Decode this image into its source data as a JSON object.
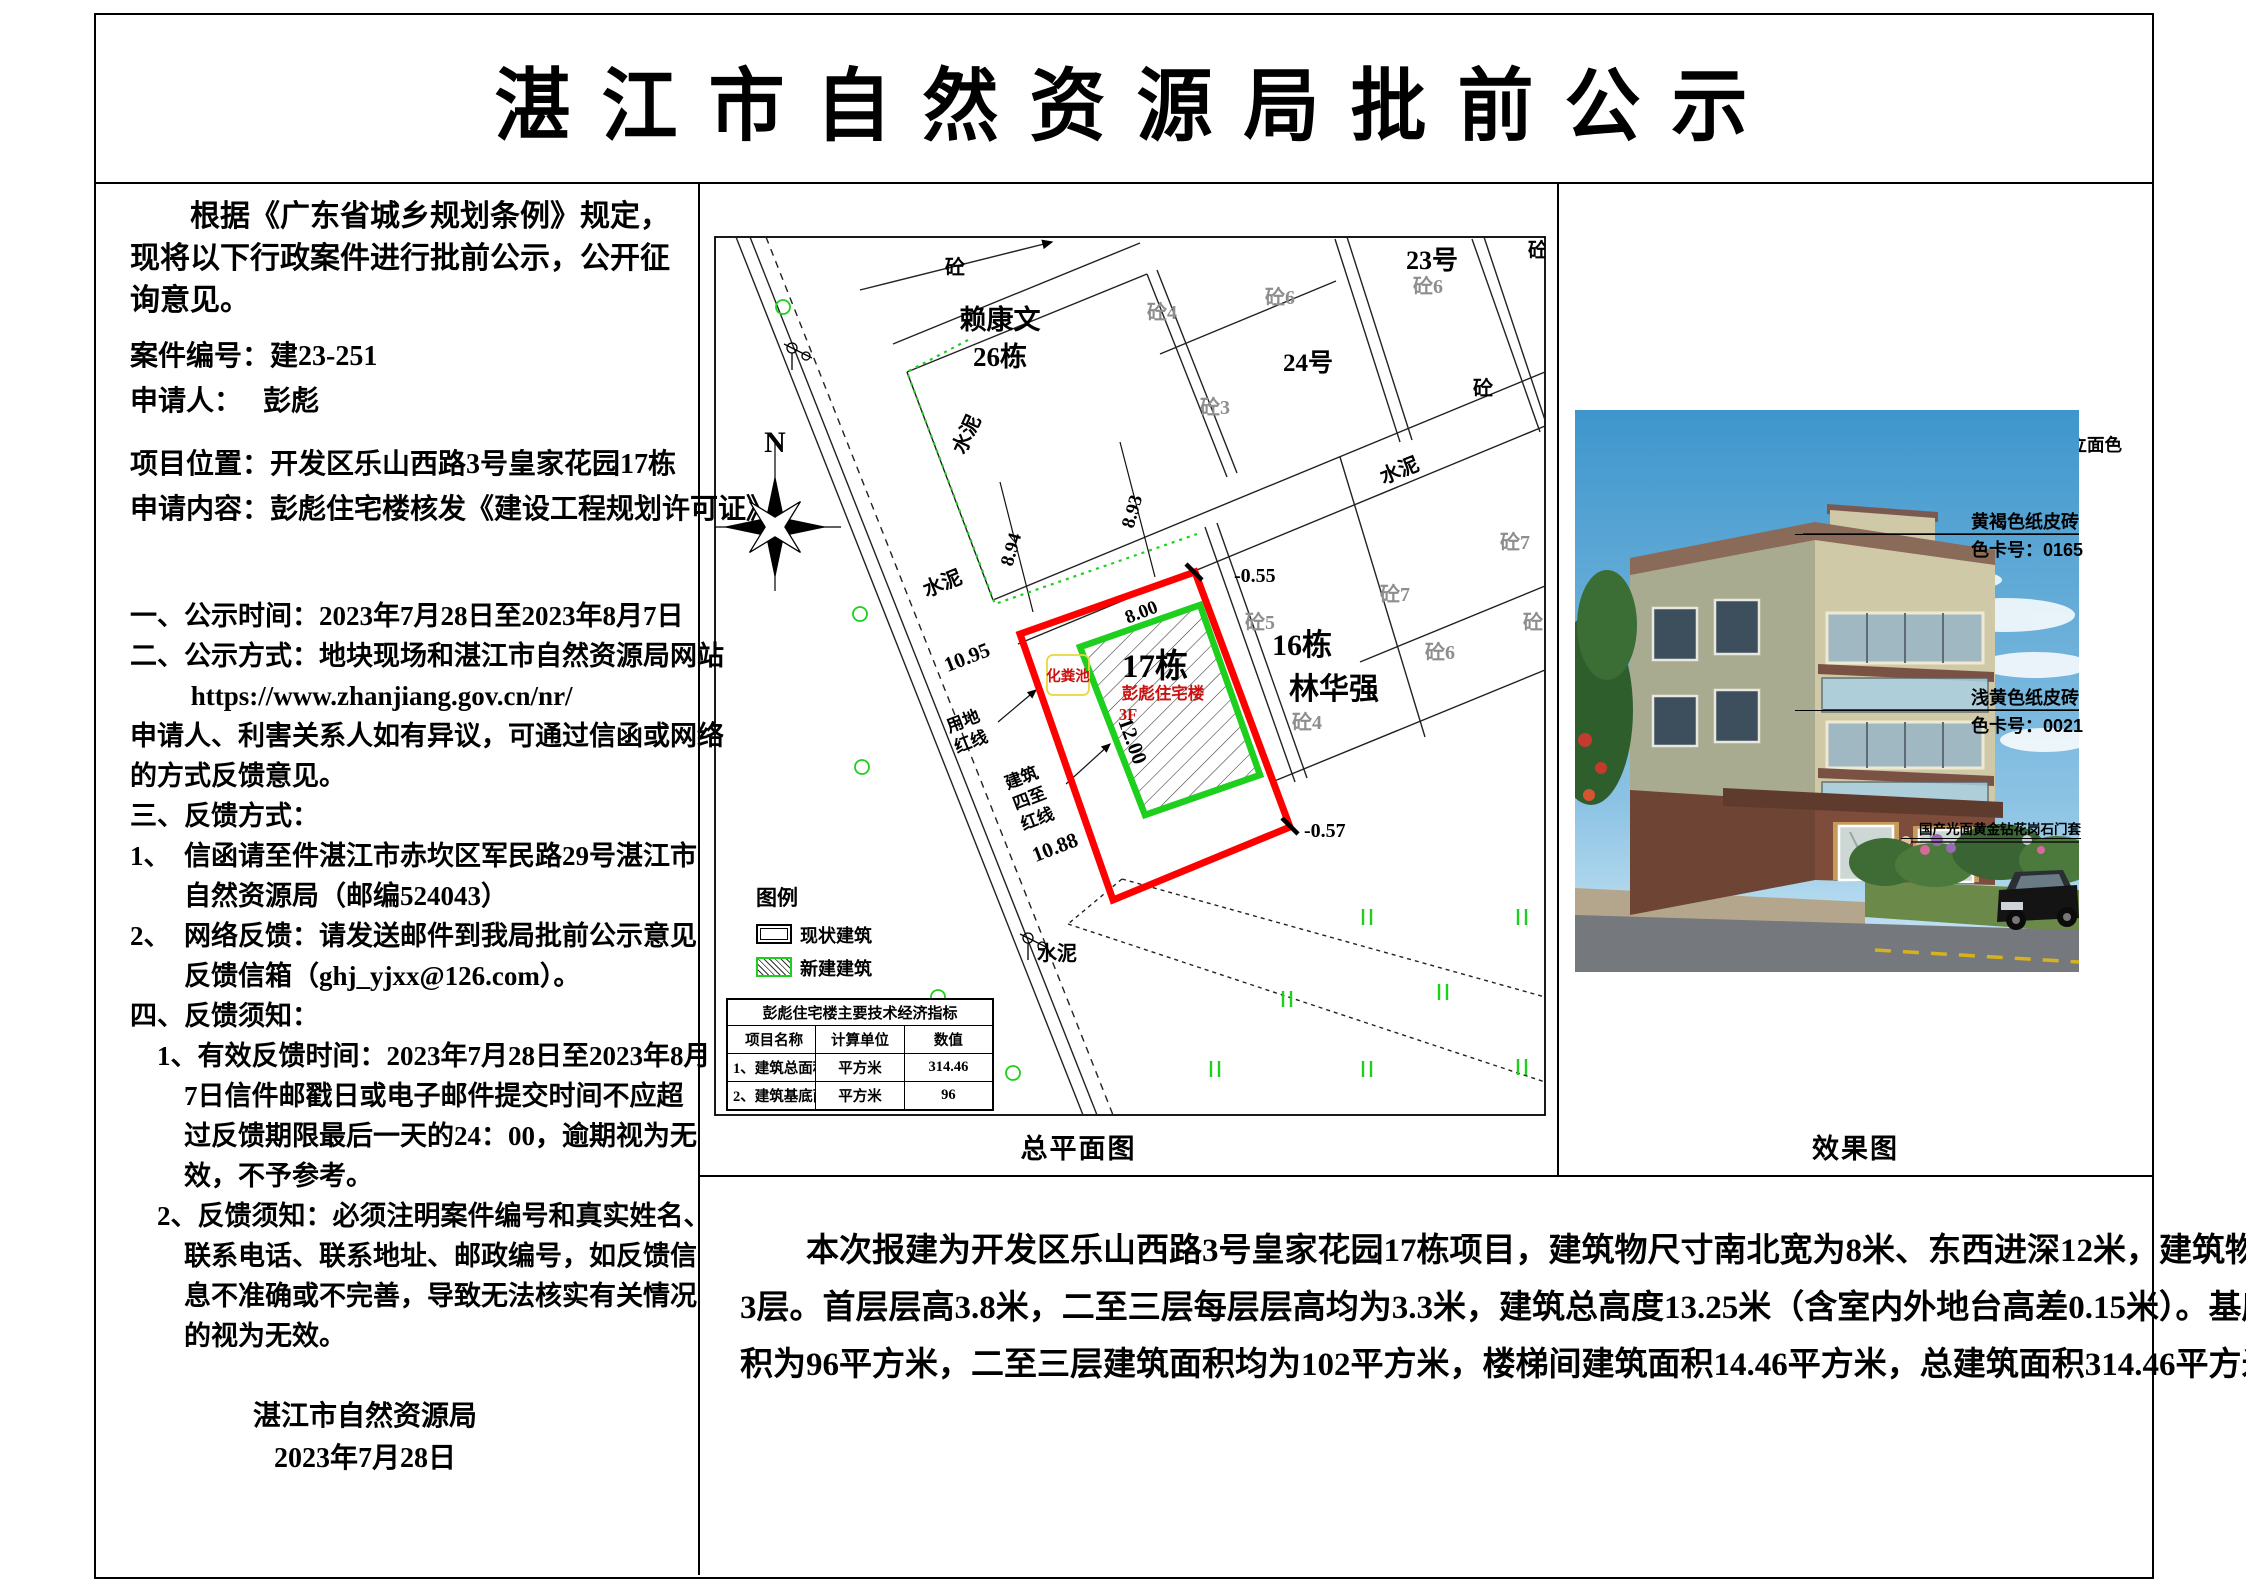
{
  "title": "湛 江 市 自 然 资 源 局 批 前 公 示",
  "left_panel": {
    "lines": [
      "　　根据《广东省城乡规划条例》规定，",
      "现将以下行政案件进行批前公示，公开征",
      "询意见。",
      "案件编号：建23-251",
      "申请人：　 彭彪",
      "项目位置：开发区乐山西路3号皇家花园17栋",
      "申请内容：彭彪住宅楼核发《建设工程规划许可证》",
      "一、公示时间：2023年7月28日至2023年8月7日",
      "二、公示方式：地块现场和湛江市自然资源局网站",
      "　　 https://www.zhanjiang.gov.cn/nr/",
      "申请人、利害关系人如有异议，可通过信函或网络",
      "的方式反馈意见。",
      "三、反馈方式：",
      "1、　信函请至件湛江市赤坎区军民路29号湛江市",
      "　　自然资源局（邮编524043）",
      "2、　网络反馈：请发送邮件到我局批前公示意见",
      "　　反馈信箱（ghj_yjxx@126.com）。",
      "四、反馈须知：",
      "　1、有效反馈时间：2023年7月28日至2023年8月",
      "　　7日信件邮戳日或电子邮件提交时间不应超",
      "　　过反馈期限最后一天的24：00，逾期视为无",
      "　　效，不予参考。",
      "　2、反馈须知：必须注明案件编号和真实姓名、",
      "　　联系电话、联系地址、邮政编号，如反馈信",
      "　　息不准确或不完善，导致无法核实有关情况",
      "　　的视为无效。",
      "湛江市自然资源局",
      "2023年7月28日"
    ]
  },
  "site_plan": {
    "caption": "总平面图",
    "north": "N",
    "labels": {
      "cement": "水泥",
      "concrete": "砼",
      "concrete3": "砼3",
      "concrete4": "砼4",
      "concrete5": "砼5",
      "concrete6": "砼6",
      "concrete7": "砼7",
      "lai_kangwen": "赖康文",
      "building26": "26栋",
      "no24": "24号",
      "no23": "23号",
      "building16": "16栋",
      "lin_huaqiang": "林华强",
      "building17": "17栋",
      "peng_biao_house": "彭彪住宅楼",
      "floors": "3F",
      "septic_tank": "化粪池",
      "land1": "用地",
      "land2": "红线",
      "bound1": "建筑",
      "bound2": "四至",
      "bound3": "红线"
    },
    "dims": {
      "d894": "8.94",
      "d893": "8.93",
      "d1095": "10.95",
      "d800": "8.00",
      "d1200": "12.00",
      "d1088": "10.88",
      "e055": "-0.55",
      "e057": "-0.57"
    },
    "legend": {
      "title": "图例",
      "existing": "现状建筑",
      "new": "新建建筑"
    },
    "table": {
      "title": "彭彪住宅楼主要技术经济指标",
      "headers": [
        "项目名称",
        "计算单位",
        "数值"
      ],
      "rows": [
        [
          "1、建筑总面积",
          "平方米",
          "314.46"
        ],
        [
          "2、建筑基底面积",
          "平方米",
          "96"
        ]
      ]
    },
    "colors": {
      "land_red_line": "#ff0000",
      "new_building_green": "#1ecf1e",
      "septic_yellow": "#e8d83a"
    }
  },
  "render_panel": {
    "caption": "效果图",
    "header": "采用《中国建筑色卡国家标准》（GB/T18922-2008）色卡编号立面色号：",
    "ann1a": "黄褐色纸皮砖",
    "ann1b": "色卡号：0165",
    "ann2a": "浅黄色纸皮砖",
    "ann2b": "色卡号：0021",
    "ann3": "国产光面黄金钻花岗石门套"
  },
  "bottom_panel": {
    "lines": [
      "　　本次报建为开发区乐山西路3号皇家花园17栋项目，建筑物尺寸南北宽为8米、东西进深12米，建筑物为地上",
      "3层。首层层高3.8米，二至三层每层层高均为3.3米，建筑总高度13.25米（含室内外地台高差0.15米）。基底面",
      "积为96平方米，二至三层建筑面积均为102平方米，楼梯间建筑面积14.46平方米，总建筑面积314.46平方米。"
    ]
  }
}
